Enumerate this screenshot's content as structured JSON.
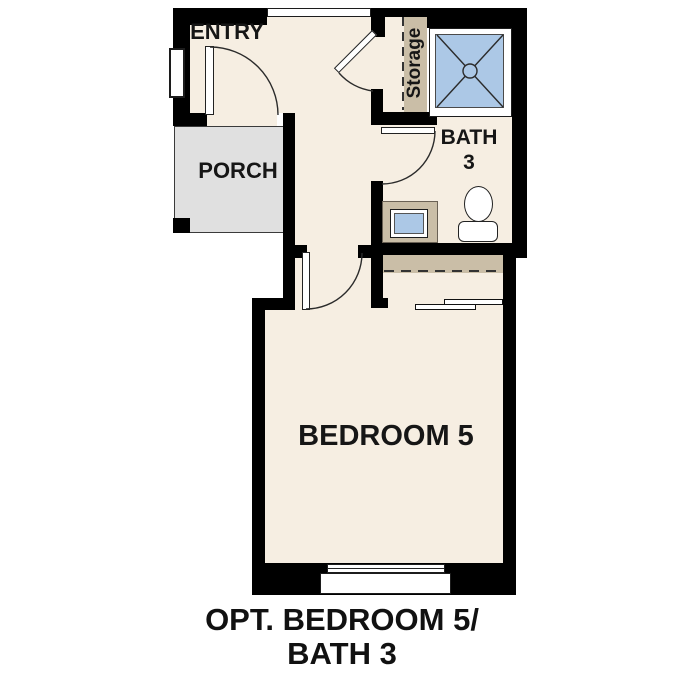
{
  "title": "Optional Bedroom 5 / Bath 3 floor plan",
  "rooms": {
    "entry": {
      "label": "ENTRY"
    },
    "porch": {
      "label": "PORCH"
    },
    "storage": {
      "label": "Storage"
    },
    "bath": {
      "label_line1": "BATH",
      "label_line2": "3"
    },
    "bedroom": {
      "label": "BEDROOM 5"
    }
  },
  "caption": {
    "line1": "OPT. BEDROOM 5/",
    "line2": "BATH 3"
  },
  "colors": {
    "background": "#ffffff",
    "wall": "#000000",
    "floor": "#f6eee2",
    "porch_slab": "#e0e0e0",
    "millwork_tan": "#cabea7",
    "fixture_blue": "#acc8e6",
    "stroke": "#2b2b2b"
  },
  "fixtures": [
    "shower-pan",
    "shower-drain",
    "shower-threshold",
    "storage-shelf",
    "storage-rod-dashed",
    "closet-shelf",
    "closet-rod-dashed",
    "sliding-bypass-doors",
    "vanity",
    "sink",
    "toilet",
    "front-door",
    "storage-door",
    "bath-door",
    "bedroom-door",
    "entry-window",
    "bedroom-box-window",
    "wall-opening"
  ]
}
